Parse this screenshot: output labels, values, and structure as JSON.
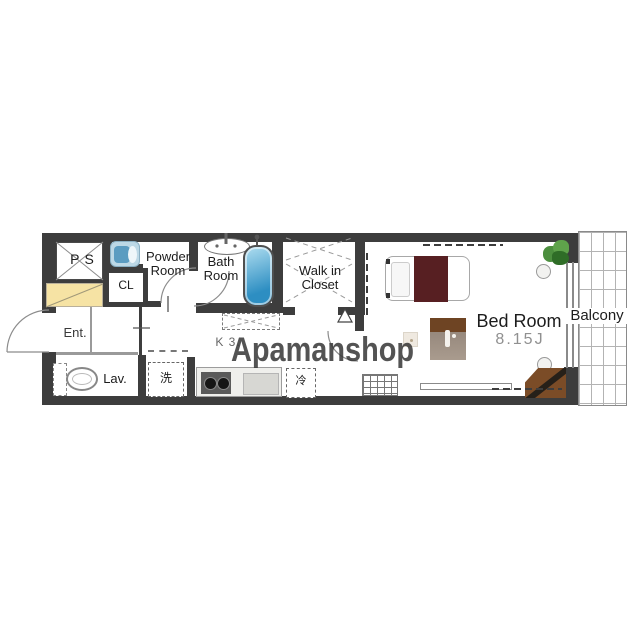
{
  "watermark": {
    "text": "Apamanshop"
  },
  "labels": {
    "ps": "PS",
    "powder_line1": "Powder",
    "powder_line2": "Room",
    "cl": "CL",
    "bath_line1": "Bath",
    "bath_line2": "Room",
    "wic_line1": "Walk in",
    "wic_line2": "Closet",
    "entrance": "Ent.",
    "lavatory": "Lav.",
    "washer": "洗",
    "fridge": "冷",
    "kitchen": "K 3.",
    "bedroom": "Bed Room",
    "bedroom_size": "8.15J",
    "balcony": "Balcony"
  },
  "colors": {
    "wall": "#3d3d3d",
    "highlight_yellow": "#f6e3a4",
    "bathtub_blue": "#2d8ec2",
    "bed_blanket_maroon": "#571f22",
    "furniture_brown": "#7b4c27",
    "plant_green": "#4c8f3e",
    "watermark_gray": "#3a3a3a"
  }
}
